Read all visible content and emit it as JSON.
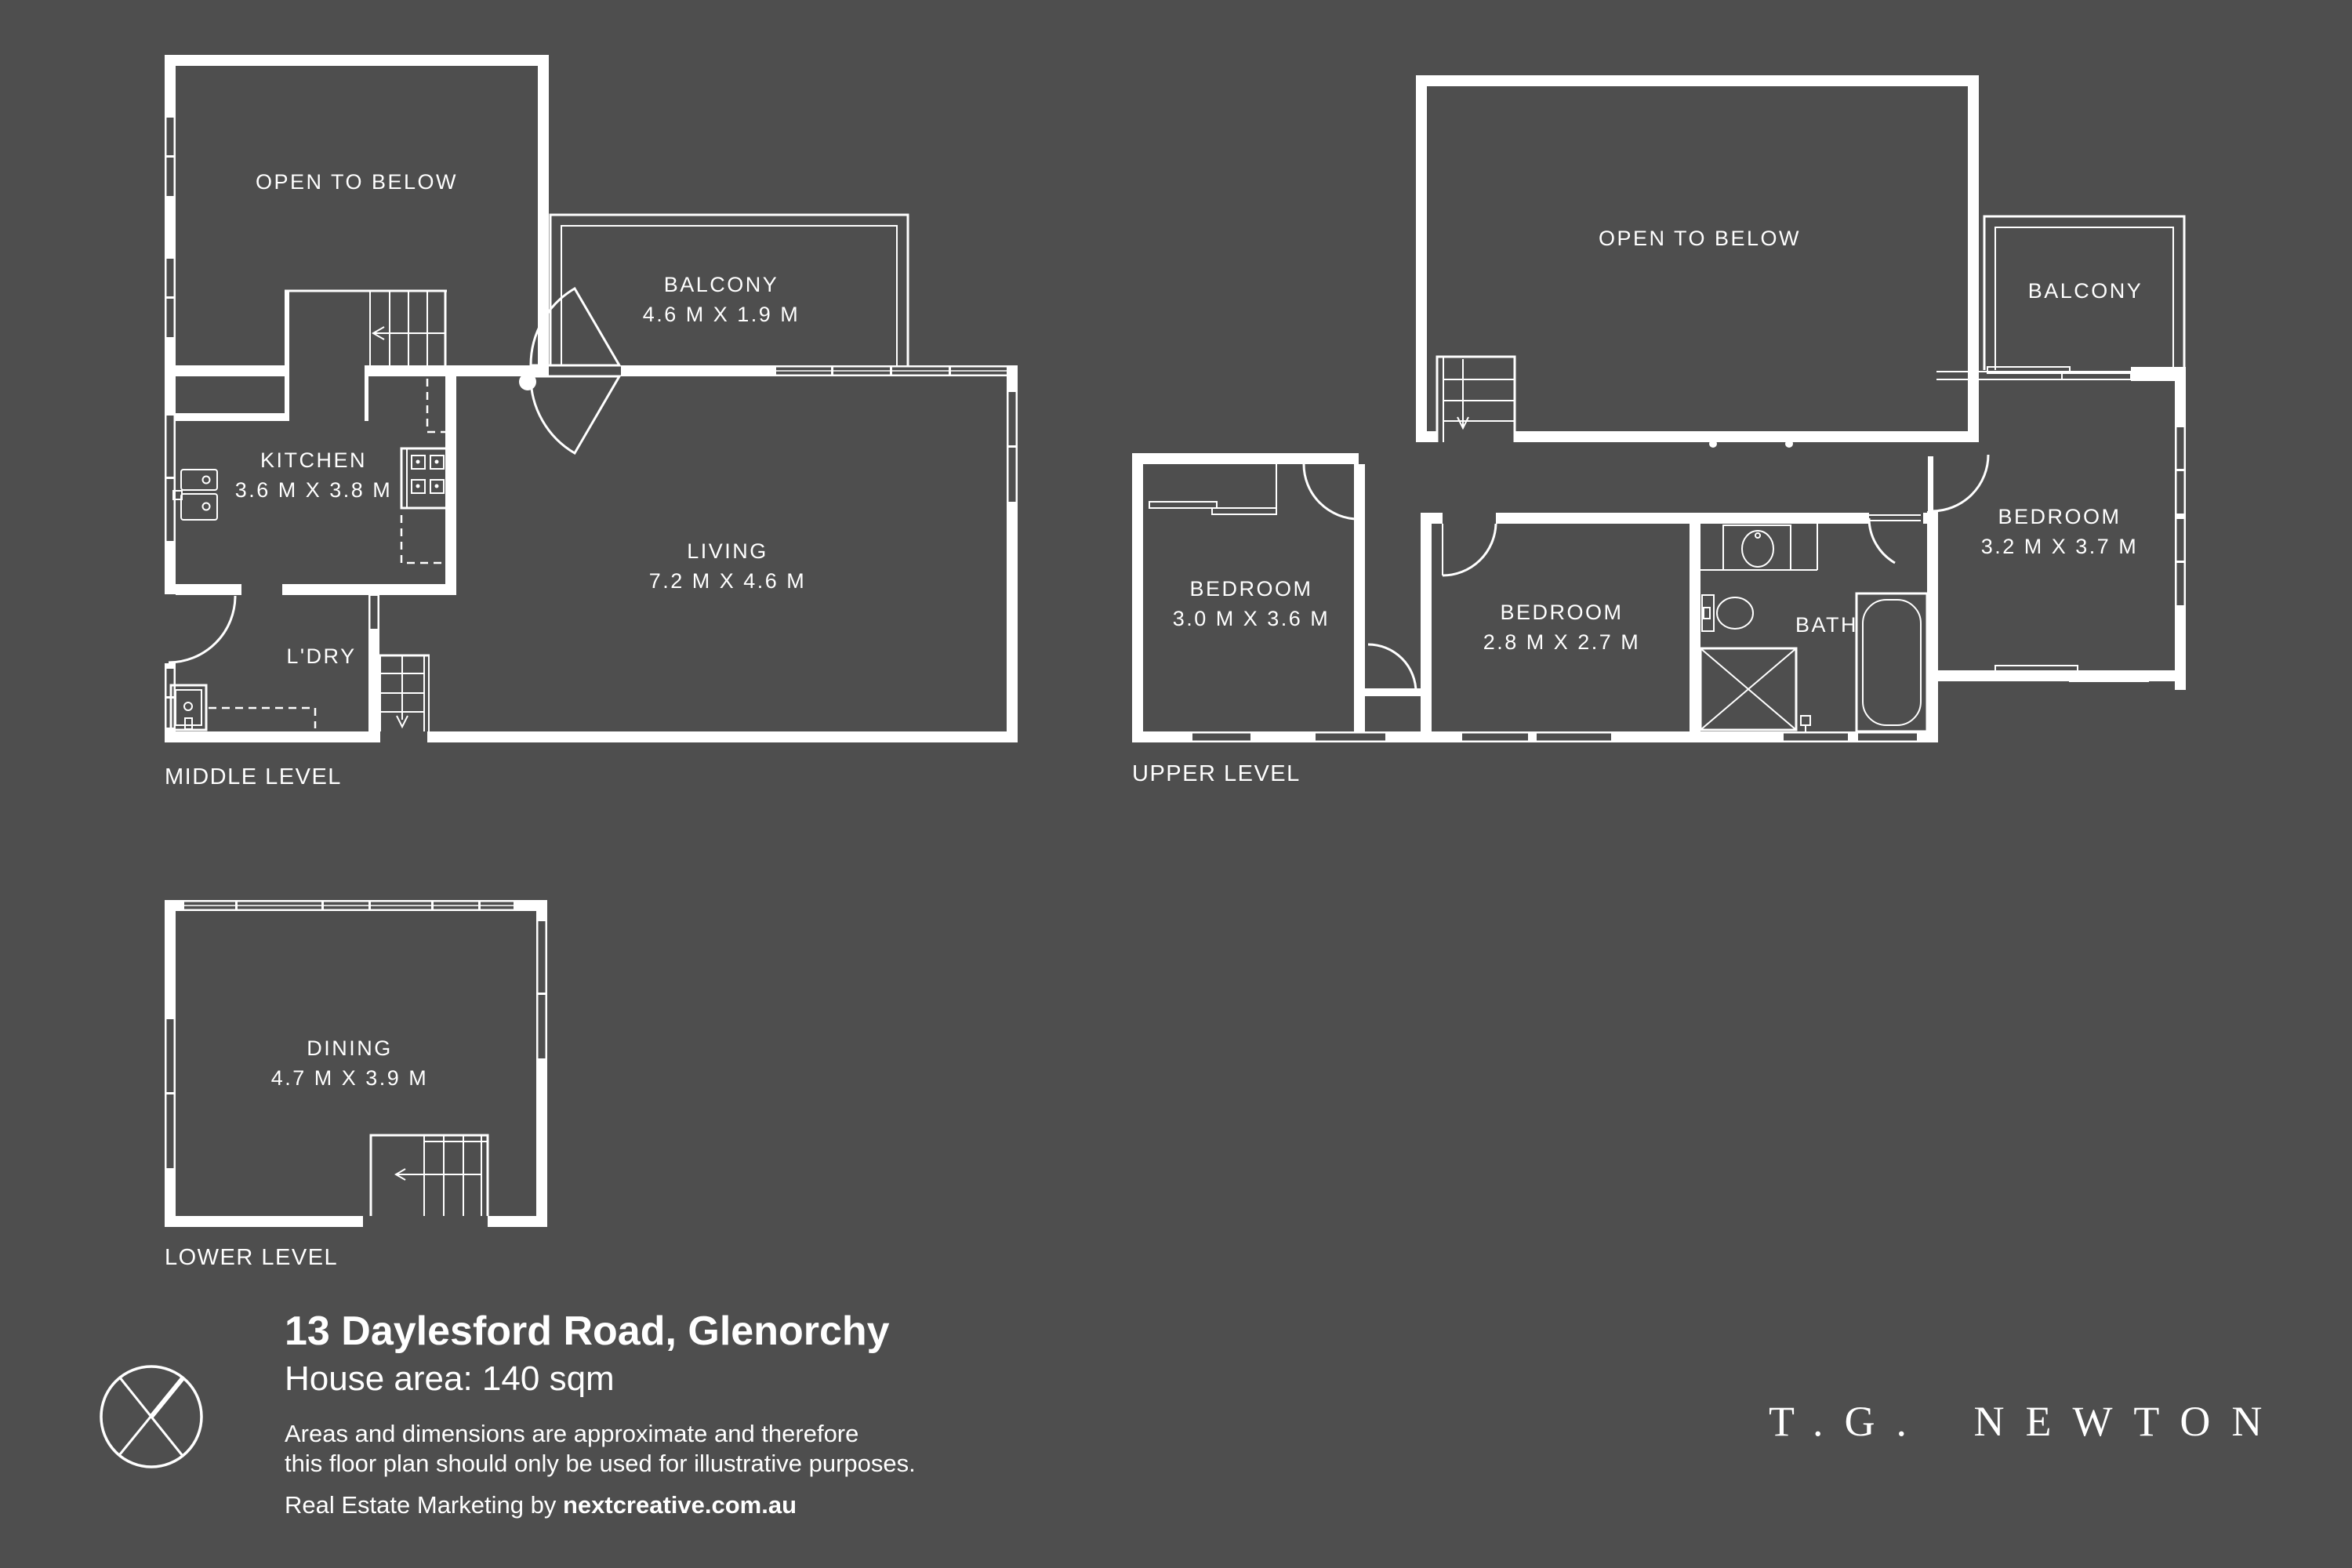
{
  "colors": {
    "background": "#4e4e4e",
    "line": "#ffffff"
  },
  "levels": {
    "middle": {
      "label": "MIDDLE LEVEL",
      "rooms": {
        "open_below": {
          "name": "OPEN TO BELOW"
        },
        "balcony": {
          "name": "BALCONY",
          "dims": "4.6 M X 1.9 M"
        },
        "kitchen": {
          "name": "KITCHEN",
          "dims": "3.6 M X 3.8 M"
        },
        "living": {
          "name": "LIVING",
          "dims": "7.2 M X 4.6 M"
        },
        "laundry": {
          "name": "L'DRY"
        }
      }
    },
    "upper": {
      "label": "UPPER LEVEL",
      "rooms": {
        "open_below": {
          "name": "OPEN TO BELOW"
        },
        "balcony": {
          "name": "BALCONY"
        },
        "bedroom1": {
          "name": "BEDROOM",
          "dims": "3.0 M X 3.6 M"
        },
        "bedroom2": {
          "name": "BEDROOM",
          "dims": "2.8 M X 2.7 M"
        },
        "bath": {
          "name": "BATH"
        },
        "bedroom3": {
          "name": "BEDROOM",
          "dims": "3.2 M X 3.7 M"
        }
      }
    },
    "lower": {
      "label": "LOWER LEVEL",
      "rooms": {
        "dining": {
          "name": "DINING",
          "dims": "4.7 M X 3.9 M"
        }
      }
    }
  },
  "footer": {
    "address": "13 Daylesford Road, Glenorchy",
    "house_area": "House area: 140 sqm",
    "disclaimer_line1": "Areas and dimensions are approximate and therefore",
    "disclaimer_line2": "this floor plan should only be used for illustrative purposes.",
    "marketing_prefix": "Real Estate Marketing by ",
    "marketing_domain": "nextcreative.com.au",
    "brand": "T.G. NEWTON"
  }
}
